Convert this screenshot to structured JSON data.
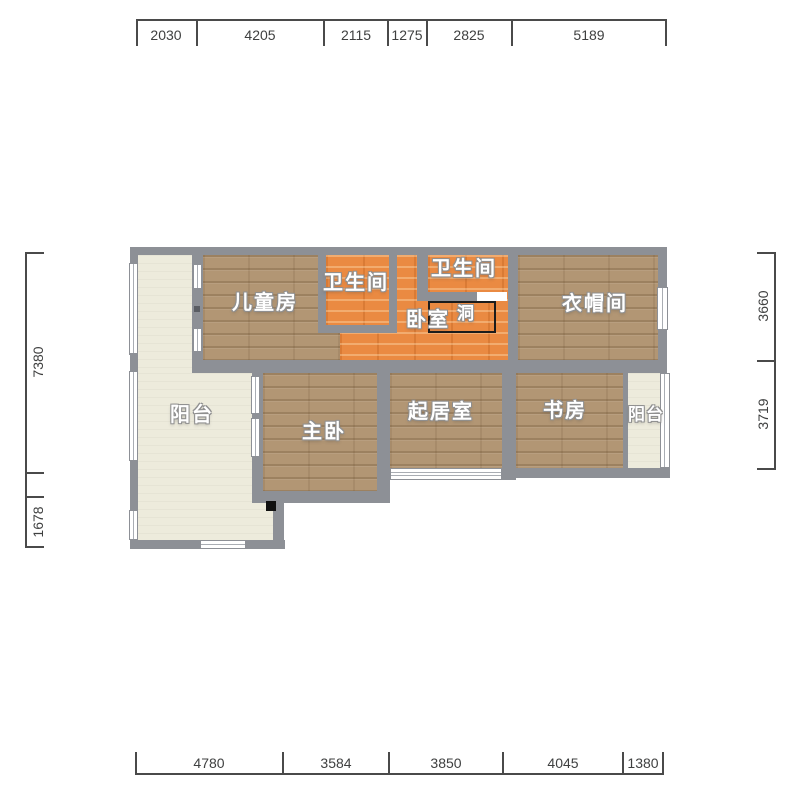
{
  "plan_title": "apartment-floor-plan",
  "rooms": {
    "children": {
      "label": "儿童房"
    },
    "bath_left": {
      "label": "卫生间"
    },
    "bath_right": {
      "label": "卫生间"
    },
    "bedroom": {
      "label": "卧室"
    },
    "hole": {
      "label": "洞"
    },
    "cloakroom": {
      "label": "衣帽间"
    },
    "balcony_left": {
      "label": "阳台"
    },
    "master": {
      "label": "主卧"
    },
    "living": {
      "label": "起居室"
    },
    "study": {
      "label": "书房"
    },
    "balcony_right": {
      "label": "阳台"
    }
  },
  "dimensions": {
    "top": [
      "2030",
      "4205",
      "2115",
      "1275",
      "2825",
      "5189"
    ],
    "bottom": [
      "4780",
      "3584",
      "3850",
      "4045",
      "1380"
    ],
    "left": [
      "7380",
      "1678"
    ],
    "right": [
      "3660",
      "3719"
    ]
  },
  "colors": {
    "wall": "#8d9096",
    "wood_floor": "#b29674",
    "tile_floor": "#ea8a42",
    "balcony_floor": "#edebdc",
    "dimension_text": "#3f4040",
    "hole_outline": "#1c1c1c",
    "background": "#ffffff"
  }
}
